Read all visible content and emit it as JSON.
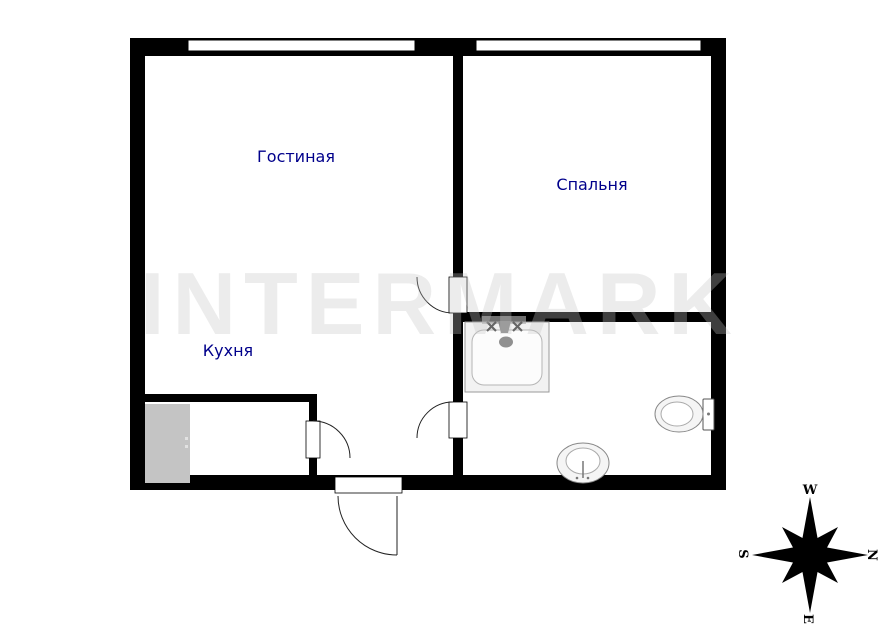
{
  "plan": {
    "rooms": {
      "living": {
        "label": "Гостиная"
      },
      "bedroom": {
        "label": "Спальня"
      },
      "kitchen": {
        "label": "Кухня"
      }
    },
    "watermark": "INTERMARK",
    "compass": {
      "top": "W",
      "right": "N",
      "bottom": "E",
      "left": "S"
    },
    "colors": {
      "wall": "#000000",
      "room_label": "#00008B",
      "wardrobe_fill": "#c4c4c4"
    },
    "fixtures": [
      "bathtub-icon",
      "toilet-icon",
      "washbasin-icon",
      "wardrobe-icon",
      "compass-rose-icon"
    ]
  }
}
